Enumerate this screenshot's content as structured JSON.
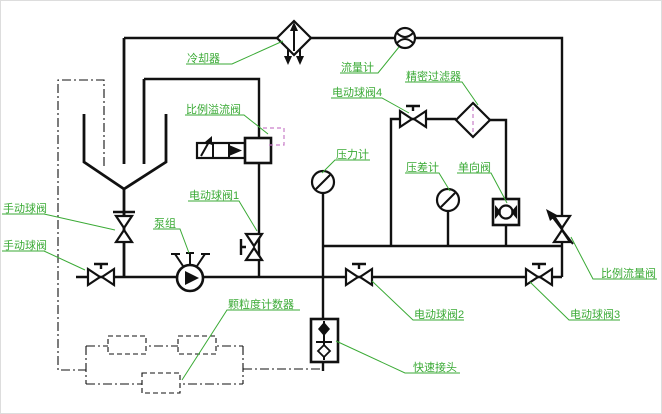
{
  "colors": {
    "line": "#111111",
    "label": "#3aaa35",
    "accent": "#c97fc9",
    "background": "#ffffff"
  },
  "labels": {
    "cooler": "冷却器",
    "flow_meter": "流量计",
    "precision_filter": "精密过滤器",
    "electric_ball_valve_4": "电动球阀4",
    "proportional_relief_valve": "比例溢流阀",
    "pressure_gauge": "压力计",
    "differential_pressure_gauge": "压差计",
    "check_valve": "单向阀",
    "electric_ball_valve_1": "电动球阀1",
    "manual_ball_valve_upper": "手动球阀",
    "manual_ball_valve_lower": "手动球阀",
    "pump_unit": "泵组",
    "particle_counter": "颗粒度计数器",
    "quick_connector": "快速接头",
    "electric_ball_valve_2": "电动球阀2",
    "electric_ball_valve_3": "电动球阀3",
    "proportional_flow_valve": "比例流量阀"
  }
}
